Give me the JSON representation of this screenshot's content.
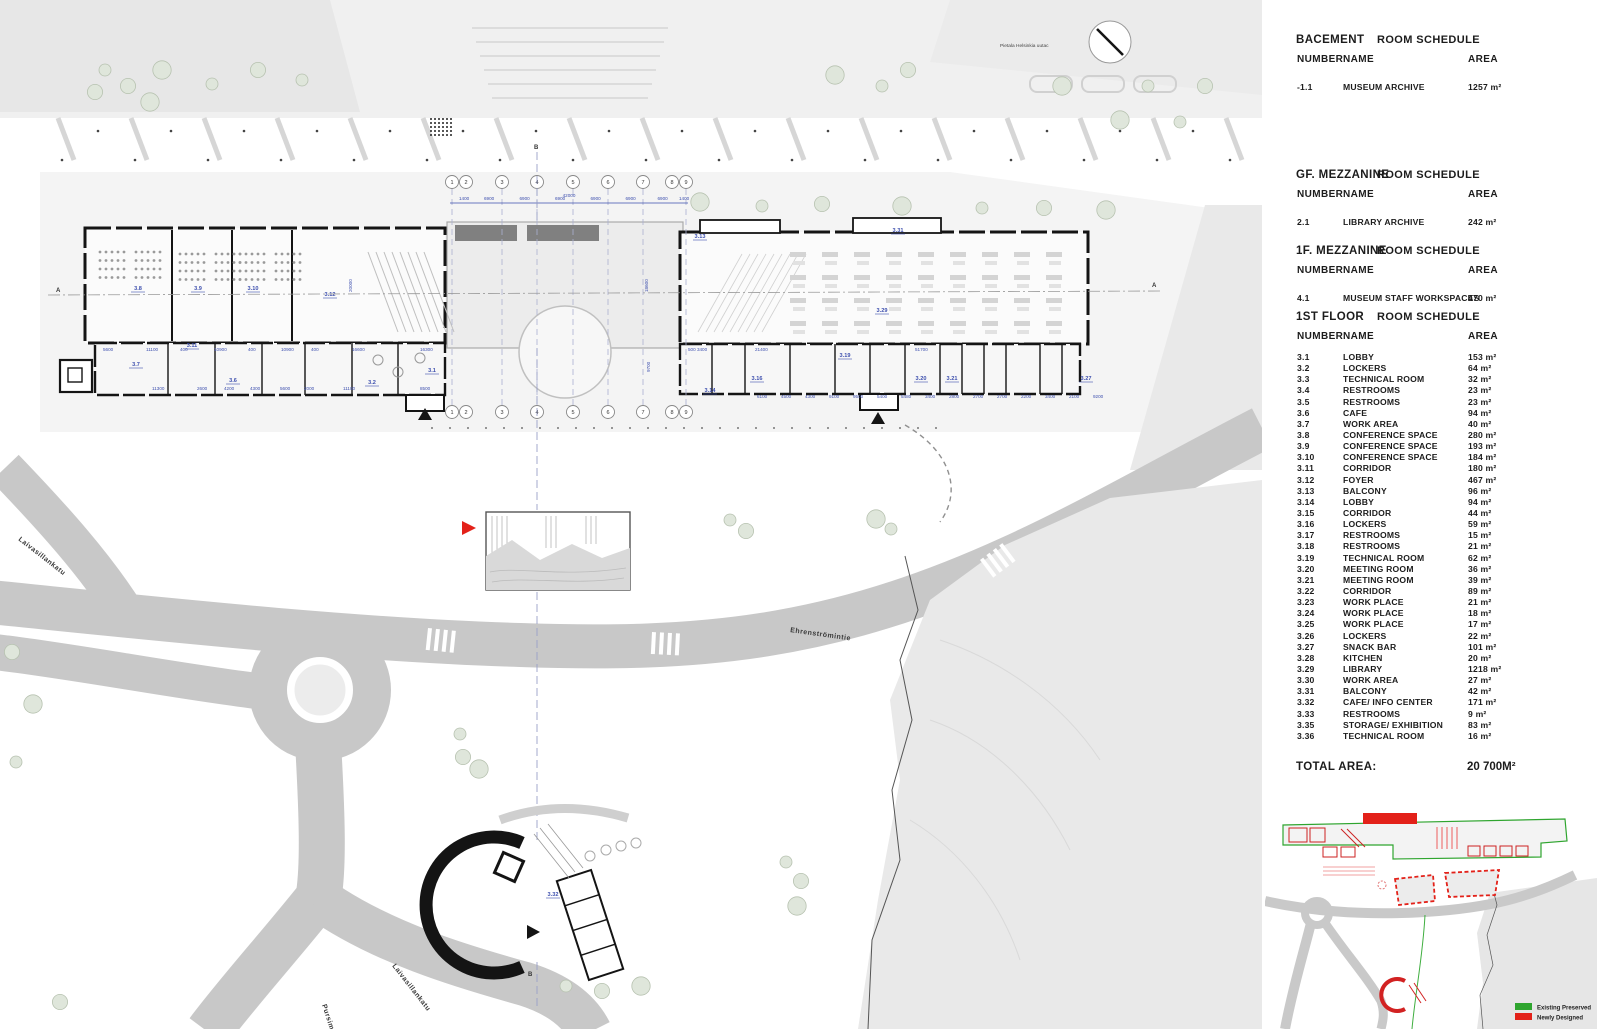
{
  "panel": {
    "tables": [
      {
        "floor_label": "BACEMENT",
        "schedule_label": "ROOM SCHEDULE",
        "headers": [
          "NUMBER",
          "NAME",
          "AREA"
        ],
        "rows": [
          {
            "number": "-1.1",
            "name": "MUSEUM ARCHIVE",
            "area": "1257 m²"
          }
        ]
      },
      {
        "floor_label": "GF. MEZZANINE",
        "schedule_label": "ROOM SCHEDULE",
        "headers": [
          "NUMBER",
          "NAME",
          "AREA"
        ],
        "rows": [
          {
            "number": "2.1",
            "name": "LIBRARY ARCHIVE",
            "area": "242 m²"
          }
        ]
      },
      {
        "floor_label": "1F. MEZZANINE",
        "schedule_label": "ROOM SCHEDULE",
        "headers": [
          "NUMBER",
          "NAME",
          "AREA"
        ],
        "rows": [
          {
            "number": "4.1",
            "name": "MUSEUM STAFF WORKSPACES",
            "area": "470 m²"
          }
        ]
      },
      {
        "floor_label": "1ST FLOOR",
        "schedule_label": "ROOM SCHEDULE",
        "headers": [
          "NUMBER",
          "NAME",
          "AREA"
        ],
        "rows": [
          {
            "number": "3.1",
            "name": "LOBBY",
            "area": "153 m²"
          },
          {
            "number": "3.2",
            "name": "LOCKERS",
            "area": "64 m²"
          },
          {
            "number": "3.3",
            "name": "TECHNICAL ROOM",
            "area": "32 m²"
          },
          {
            "number": "3.4",
            "name": "RESTROOMS",
            "area": "23 m²"
          },
          {
            "number": "3.5",
            "name": "RESTROOMS",
            "area": "23 m²"
          },
          {
            "number": "3.6",
            "name": "CAFE",
            "area": "94 m²"
          },
          {
            "number": "3.7",
            "name": "WORK AREA",
            "area": "40 m²"
          },
          {
            "number": "3.8",
            "name": "CONFERENCE SPACE",
            "area": "280 m²"
          },
          {
            "number": "3.9",
            "name": "CONFERENCE SPACE",
            "area": "193 m²"
          },
          {
            "number": "3.10",
            "name": "CONFERENCE SPACE",
            "area": "184 m²"
          },
          {
            "number": "3.11",
            "name": "CORRIDOR",
            "area": "180 m²"
          },
          {
            "number": "3.12",
            "name": "FOYER",
            "area": "467 m²"
          },
          {
            "number": "3.13",
            "name": "BALCONY",
            "area": "96 m²"
          },
          {
            "number": "3.14",
            "name": "LOBBY",
            "area": "94 m²"
          },
          {
            "number": "3.15",
            "name": "CORRIDOR",
            "area": "44 m²"
          },
          {
            "number": "3.16",
            "name": "LOCKERS",
            "area": "59 m²"
          },
          {
            "number": "3.17",
            "name": "RESTROOMS",
            "area": "15 m²"
          },
          {
            "number": "3.18",
            "name": "RESTROOMS",
            "area": "21 m²"
          },
          {
            "number": "3.19",
            "name": "TECHNICAL ROOM",
            "area": "62 m²"
          },
          {
            "number": "3.20",
            "name": "MEETING ROOM",
            "area": "36 m²"
          },
          {
            "number": "3.21",
            "name": "MEETING ROOM",
            "area": "39 m²"
          },
          {
            "number": "3.22",
            "name": "CORRIDOR",
            "area": "89 m²"
          },
          {
            "number": "3.23",
            "name": "WORK PLACE",
            "area": "21 m²"
          },
          {
            "number": "3.24",
            "name": "WORK PLACE",
            "area": "18 m²"
          },
          {
            "number": "3.25",
            "name": "WORK PLACE",
            "area": "17 m²"
          },
          {
            "number": "3.26",
            "name": "LOCKERS",
            "area": "22 m²"
          },
          {
            "number": "3.27",
            "name": "SNACK BAR",
            "area": "101 m²"
          },
          {
            "number": "3.28",
            "name": "KITCHEN",
            "area": "20 m²"
          },
          {
            "number": "3.29",
            "name": "LIBRARY",
            "area": "1218 m²"
          },
          {
            "number": "3.30",
            "name": "WORK AREA",
            "area": "27 m²"
          },
          {
            "number": "3.31",
            "name": "BALCONY",
            "area": "42 m²"
          },
          {
            "number": "3.32",
            "name": "CAFE/ INFO CENTER",
            "area": "171 m²"
          },
          {
            "number": "3.33",
            "name": "RESTROOMS",
            "area": "9 m²"
          },
          {
            "number": "3.35",
            "name": "STORAGE/ EXHIBITION",
            "area": "83 m²"
          },
          {
            "number": "3.36",
            "name": "TECHNICAL ROOM",
            "area": "16 m²"
          }
        ]
      }
    ],
    "total_label": "TOTAL AREA:",
    "total_value": "20 700M²",
    "legend": [
      {
        "label": "Existing Preserved",
        "color": "#2fa52f"
      },
      {
        "label": "Newly Designed",
        "color": "#e32119"
      }
    ]
  },
  "plan": {
    "caption": "Pietala Helsinkia uutac",
    "streets": {
      "left": "Laivasillankatu",
      "middle": "Ehrenströmintie",
      "bottom_left": "Pursimiehenkatu",
      "bottom_right": "Laivasillankatu"
    },
    "section_markers": {
      "a": "A",
      "b": "B"
    },
    "grid_bubbles": [
      "1",
      "2",
      "3",
      "4",
      "5",
      "6",
      "7",
      "8",
      "9"
    ],
    "overall_dim": "42000",
    "top_dims": [
      "1400",
      "6900",
      "6900",
      "6900",
      "6900",
      "6900",
      "6900",
      "1400"
    ],
    "left_bottom_dims": [
      "5600",
      "11100",
      "400",
      "10900",
      "400",
      "10900",
      "400",
      "16600",
      "16300"
    ],
    "left_lower_dims": [
      "11300",
      "2600",
      "4200",
      "4300",
      "5600",
      "2000",
      "11100",
      "8500"
    ],
    "right_bottom_dims": [
      "500 3400",
      "21400",
      "51700"
    ],
    "right_lower_dims": [
      "6100",
      "4500",
      "4300",
      "9100",
      "9500",
      "5400",
      "5480",
      "3400",
      "2800",
      "2700",
      "2700",
      "2200",
      "3400",
      "2100",
      "9200"
    ],
    "vertical_dims": [
      "20000",
      "18600",
      "9700"
    ],
    "room_labels": [
      "3.8",
      "3.9",
      "3.10",
      "3.12",
      "3.11",
      "3.7",
      "3.6",
      "3.2",
      "3.1",
      "3.13",
      "3.31",
      "3.29",
      "3.16",
      "3.19",
      "3.14",
      "3.20",
      "3.21",
      "3.27",
      "3.32",
      "3.35",
      "3.36"
    ],
    "colors": {
      "dimension_blue": "#3d4fae",
      "accent_red": "#e32119",
      "wall_black": "#141414",
      "existing_green": "#2fa52f"
    }
  }
}
